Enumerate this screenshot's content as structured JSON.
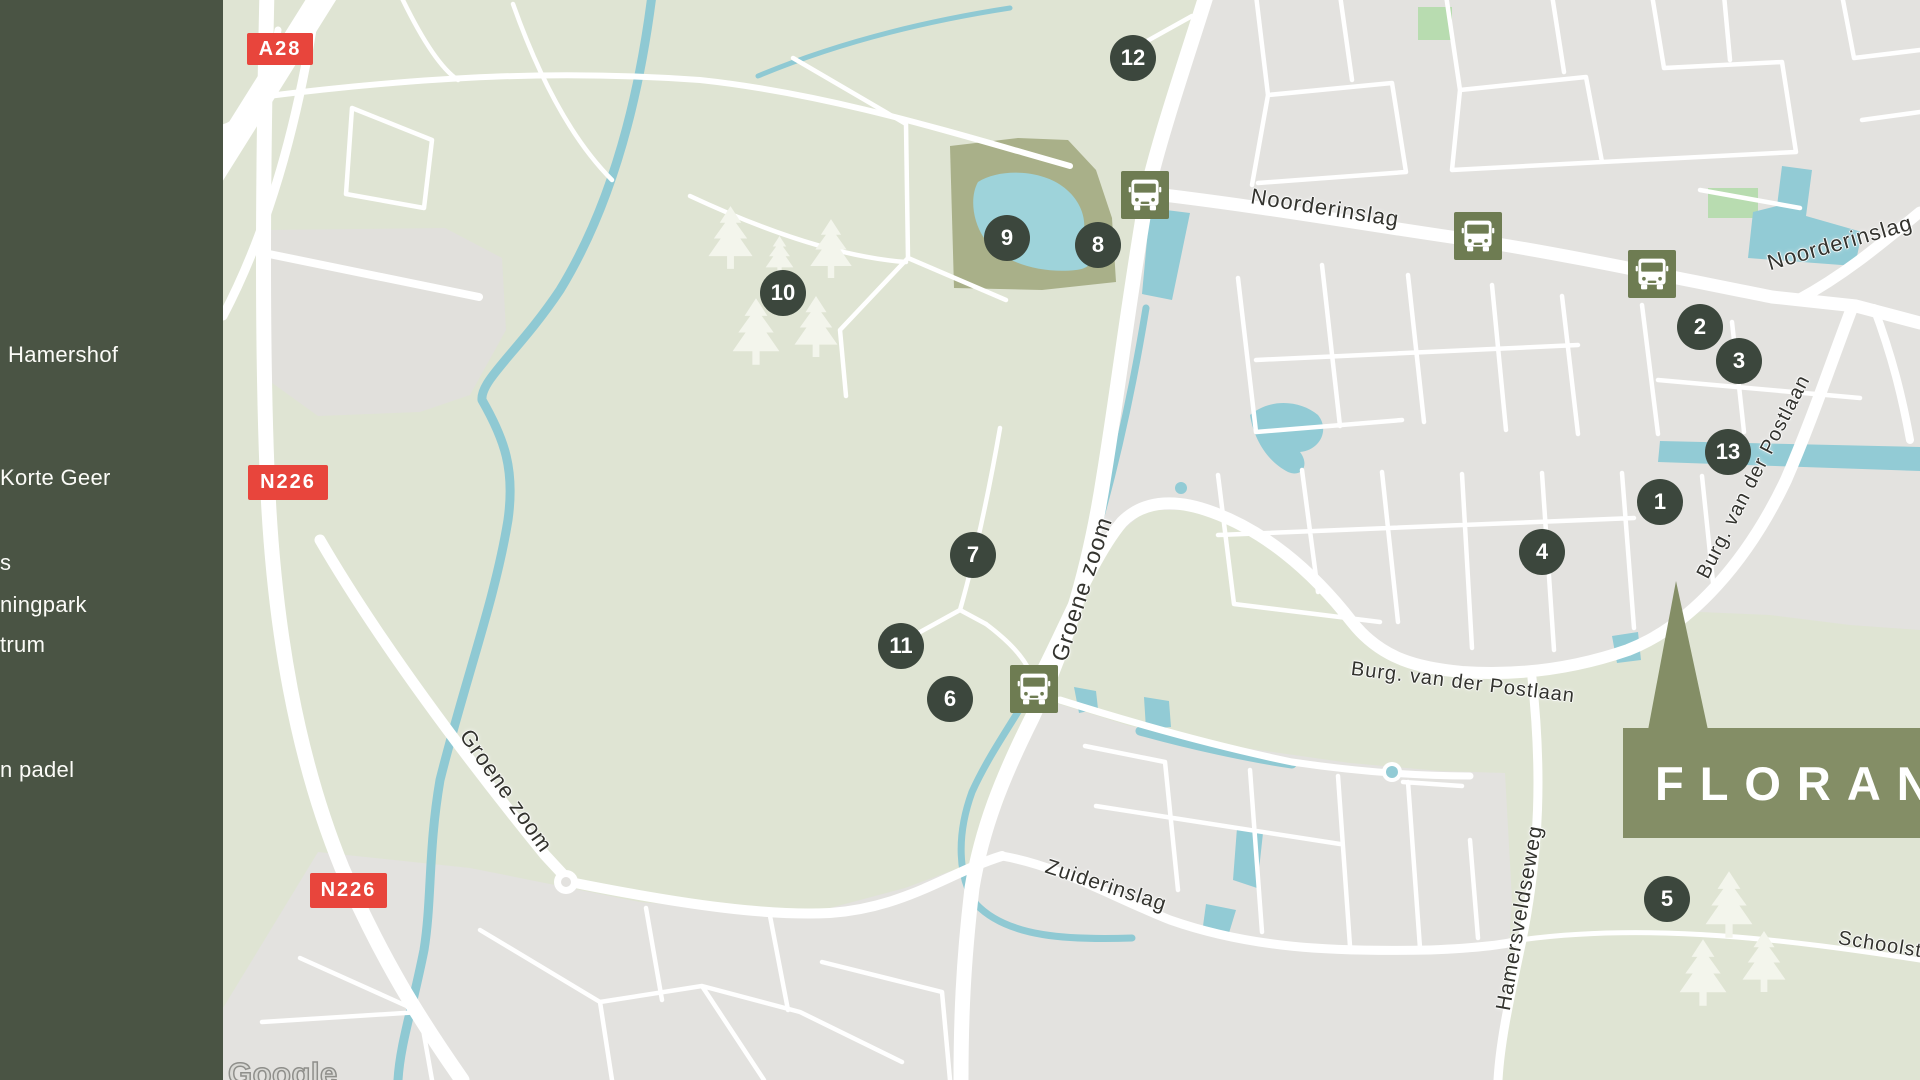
{
  "theme": {
    "sidebar_bg": "#4a5444",
    "marker_bg": "#3c473d",
    "bus_bg": "#6e7c52",
    "flag_bg": "#848e66",
    "badge_bg": "#e8453c",
    "label_ink": "#33332e",
    "nature": "#dfe4d3",
    "urban": "#e3e2df",
    "water": "#92cbd5",
    "park": "#a9b089",
    "tree": "#f3f5ec",
    "road": "#ffffff"
  },
  "sidebar": {
    "items": [
      {
        "label": "Hamershof",
        "y": 355,
        "dx": 8
      },
      {
        "label": "Korte Geer",
        "y": 478,
        "dx": 0
      },
      {
        "label": "s",
        "y": 563,
        "dx": 0
      },
      {
        "label": "ningpark",
        "y": 605,
        "dx": 0
      },
      {
        "label": "trum",
        "y": 645,
        "dx": 0
      },
      {
        "label": "n padel",
        "y": 770,
        "dx": 0
      }
    ]
  },
  "map": {
    "route_badges": [
      {
        "text": "A28",
        "x": 247,
        "y": 33,
        "w": 66,
        "h": 32
      },
      {
        "text": "N226",
        "x": 248,
        "y": 465,
        "w": 80,
        "h": 35
      },
      {
        "text": "N226",
        "x": 310,
        "y": 873,
        "w": 77,
        "h": 35
      }
    ],
    "markers": [
      {
        "n": "1",
        "x": 1660,
        "y": 502
      },
      {
        "n": "2",
        "x": 1700,
        "y": 327
      },
      {
        "n": "3",
        "x": 1739,
        "y": 361
      },
      {
        "n": "4",
        "x": 1542,
        "y": 552
      },
      {
        "n": "5",
        "x": 1667,
        "y": 899
      },
      {
        "n": "6",
        "x": 950,
        "y": 699
      },
      {
        "n": "7",
        "x": 973,
        "y": 555
      },
      {
        "n": "8",
        "x": 1098,
        "y": 245
      },
      {
        "n": "9",
        "x": 1007,
        "y": 238
      },
      {
        "n": "10",
        "x": 783,
        "y": 293
      },
      {
        "n": "11",
        "x": 901,
        "y": 646
      },
      {
        "n": "12",
        "x": 1133,
        "y": 58
      },
      {
        "n": "13",
        "x": 1728,
        "y": 452
      }
    ],
    "bus_stops": [
      {
        "x": 1145,
        "y": 195
      },
      {
        "x": 1478,
        "y": 236
      },
      {
        "x": 1652,
        "y": 274
      },
      {
        "x": 1034,
        "y": 689
      }
    ],
    "road_labels": [
      {
        "text": "Noorderinslag",
        "x": 1325,
        "y": 208,
        "rot": 9,
        "size": 22
      },
      {
        "text": "Noorderinslag",
        "x": 1840,
        "y": 243,
        "rot": -16,
        "size": 22
      },
      {
        "text": "Groene zoom",
        "x": 1082,
        "y": 589,
        "rot": -72,
        "size": 23
      },
      {
        "text": "Groene zoom",
        "x": 506,
        "y": 791,
        "rot": 55,
        "size": 22
      },
      {
        "text": "Zuiderinslag",
        "x": 1106,
        "y": 886,
        "rot": 18,
        "size": 21
      },
      {
        "text": "Burg. van der Postlaan",
        "x": 1463,
        "y": 683,
        "rot": 7,
        "size": 20
      },
      {
        "text": "Burg. van der Postlaan",
        "x": 1754,
        "y": 477,
        "rot": -63,
        "size": 20
      },
      {
        "text": "Hamersveldseweg",
        "x": 1520,
        "y": 918,
        "rot": -80,
        "size": 21
      },
      {
        "text": "Schoolste",
        "x": 1886,
        "y": 946,
        "rot": 9,
        "size": 20
      }
    ],
    "trees": [
      {
        "x": 730,
        "y": 206,
        "h": 64
      },
      {
        "x": 779,
        "y": 236,
        "h": 40
      },
      {
        "x": 831,
        "y": 219,
        "h": 60
      },
      {
        "x": 756,
        "y": 298,
        "h": 68
      },
      {
        "x": 816,
        "y": 296,
        "h": 62
      },
      {
        "x": 1729,
        "y": 871,
        "h": 68
      },
      {
        "x": 1703,
        "y": 939,
        "h": 68
      },
      {
        "x": 1764,
        "y": 931,
        "h": 62
      }
    ]
  },
  "flag": {
    "label": "FLORANT",
    "x": 1623,
    "y": 728,
    "w": 297,
    "h": 110
  },
  "attribution": {
    "text": "Google"
  }
}
